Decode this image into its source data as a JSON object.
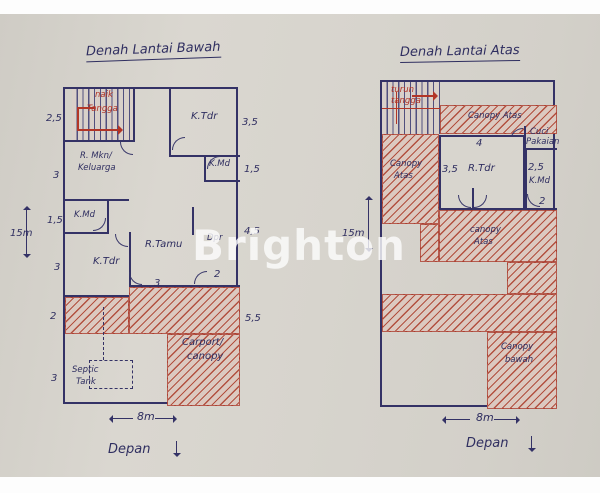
{
  "watermark": "Brighton",
  "ground_floor": {
    "title": "Denah Lantai Bawah",
    "stairs": {
      "line1": "naik",
      "line2": "Tangga"
    },
    "rooms": {
      "bedroom_top": "K.Tdr",
      "dining_line1": "R. Mkn/",
      "dining_line2": "Keluarga",
      "bath_right": "K.Md",
      "bath_left": "K.Md",
      "bedroom_bottom": "K.Tdr",
      "living": "R.Tamu",
      "kitchen": "Dpr",
      "carport_line1": "Carport/",
      "carport_line2": "canopy",
      "septic_line1": "Septic",
      "septic_line2": "Tank"
    },
    "dims": {
      "left_1": "2,5",
      "left_2": "3",
      "left_3": "1,5",
      "left_4": "3",
      "left_5": "2",
      "left_6": "3",
      "right_1": "3,5",
      "right_2": "1,5",
      "right_3": "4,5",
      "right_4": "5,5",
      "inner_living": "3",
      "inner_kitchen": "2",
      "height": "15m",
      "width": "8m"
    },
    "front_label": "Depan"
  },
  "upper_floor": {
    "title": "Denah Lantai Atas",
    "stairs": {
      "line1": "turun",
      "line2": "tangga"
    },
    "rooms": {
      "canopy_top": "Canopy Atas",
      "laundry_line1": "Cuci",
      "laundry_line2": "Pakaian",
      "bedroom": "R.Tdr",
      "bath": "K.Md",
      "canopy_left_line1": "Canopy",
      "canopy_left_line2": "Atas",
      "canopy_mid_line1": "canopy",
      "canopy_mid_line2": "Atas",
      "canopy_bottom_line1": "Canopy",
      "canopy_bottom_line2": "bawah"
    },
    "dims": {
      "top": "4",
      "bedroom_left": "3,5",
      "bath_top": "2,5",
      "door": "2",
      "height": "15m",
      "width": "8m"
    },
    "front_label": "Depan"
  }
}
